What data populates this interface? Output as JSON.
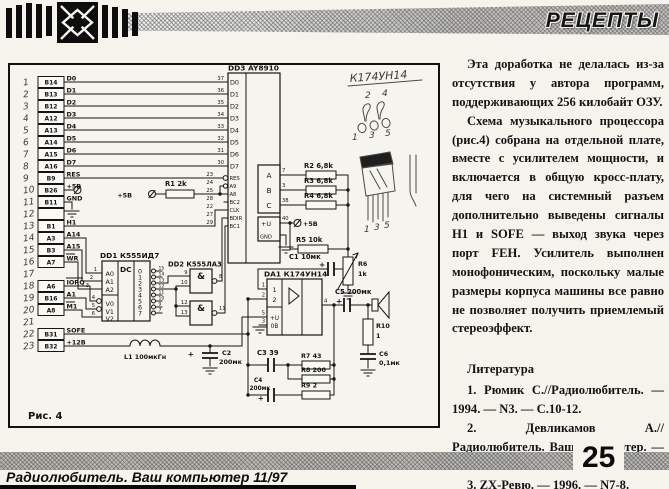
{
  "header": {
    "title": "РЕЦЕПТЫ",
    "logo_icon": "crossed-arrows-emblem"
  },
  "article": {
    "p1": "Эта доработка не делалась из-за отсутствия у автора программ, поддерживающих 256 килобайт ОЗУ.",
    "p2": "Схема музыкального процессора (рис.4) собрана на отдельной плате, вместе с усилителем мощности, и включается в общую кросс-плату, для чего на системный разъем дополнительно выведены сигналы H1 и SOFE — выход звука через порт FEH. Усилитель выполнен монофоническим, поскольку малые размеры корпуса машины все равно не позволяет получить приемлемый стереоэффект.",
    "lit": {
      "heading": "Литература",
      "i1": "1. Рюмик С.//Радиолюбитель. — 1994. — N3. — С.10-12.",
      "i2": "2. Девликамов А.//Радиолюбитель. Ваш компьютер. — 1996. — N7. — С.19-21.",
      "i3": "3. ZX-Ревю. — 1996. — N7-8."
    }
  },
  "footer": {
    "page": "25",
    "line": "Радиолюбитель. Ваш компьютер 11/97"
  },
  "schematic": {
    "caption": "Рис. 4",
    "plus": "+",
    "p5": "+5В",
    "connector": {
      "rows": [
        {
          "hand": "1",
          "pin": "B14",
          "sig": "D0",
          "num": "37"
        },
        {
          "hand": "2",
          "pin": "B13",
          "sig": "D1",
          "num": "36"
        },
        {
          "hand": "3",
          "pin": "B12",
          "sig": "D2",
          "num": "35"
        },
        {
          "hand": "4",
          "pin": "A12",
          "sig": "D3",
          "num": "34"
        },
        {
          "hand": "5",
          "pin": "A13",
          "sig": "D4",
          "num": "33"
        },
        {
          "hand": "6",
          "pin": "A14",
          "sig": "D5",
          "num": "32"
        },
        {
          "hand": "7",
          "pin": "A15",
          "sig": "D6",
          "num": "31"
        },
        {
          "hand": "8",
          "pin": "A16",
          "sig": "D7",
          "num": "30"
        },
        {
          "hand": "9",
          "pin": "B9",
          "sig": "RES",
          "num": ""
        },
        {
          "hand": "10",
          "pin": "B26",
          "sig": "+5В",
          "num": ""
        },
        {
          "hand": "11",
          "pin": "B11",
          "sig": "GND",
          "num": ""
        },
        {
          "hand": "12",
          "pin": "",
          "sig": "",
          "num": "",
          "box": true
        },
        {
          "hand": "13",
          "pin": "B1",
          "sig": "H1",
          "num": ""
        },
        {
          "hand": "14",
          "pin": "A3",
          "sig": "A14",
          "num": ""
        },
        {
          "hand": "15",
          "pin": "B3",
          "sig": "A15",
          "num": ""
        },
        {
          "hand": "16",
          "pin": "A7",
          "sig": "WR",
          "num": "",
          "inv": true
        },
        {
          "hand": "17",
          "pin": "",
          "sig": "",
          "num": ""
        },
        {
          "hand": "18",
          "pin": "A6",
          "sig": "IORQ",
          "num": "",
          "inv": true
        },
        {
          "hand": "19",
          "pin": "B16",
          "sig": "A1",
          "num": ""
        },
        {
          "hand": "20",
          "pin": "A8",
          "sig": "M1",
          "num": "",
          "inv": true
        },
        {
          "hand": "21",
          "pin": "",
          "sig": "",
          "num": ""
        },
        {
          "hand": "22",
          "pin": "B31",
          "sig": "SOFE",
          "num": ""
        },
        {
          "hand": "23",
          "pin": "B32",
          "sig": "+12В",
          "num": ""
        }
      ]
    },
    "dd3": {
      "ref": "DD3 AY8910",
      "dpins": [
        "D0",
        "D1",
        "D2",
        "D3",
        "D4",
        "D5",
        "D6",
        "D7"
      ],
      "ctrl": [
        {
          "num": "23",
          "name": "RES"
        },
        {
          "num": "24",
          "name": "A9"
        },
        {
          "num": "25",
          "name": "A8"
        },
        {
          "num": "28",
          "name": "BC2"
        },
        {
          "num": "22",
          "name": "CLK"
        },
        {
          "num": "27",
          "name": "BDIR"
        },
        {
          "num": "29",
          "name": "BC1"
        }
      ],
      "out": [
        {
          "name": "A",
          "num": "7"
        },
        {
          "name": "B",
          "num": "3"
        },
        {
          "name": "C",
          "num": "38"
        }
      ],
      "pwr": {
        "u": "+U",
        "unum": "40",
        "gnd": "GND"
      }
    },
    "dd1": {
      "ref": "DD1 К555ИД7",
      "dc": "DC",
      "a": [
        "A0",
        "A1",
        "A2"
      ],
      "anums": [
        "1",
        "2",
        "3"
      ],
      "v": [
        "V0",
        "V1",
        "V2"
      ],
      "vnums": [
        "4",
        "5",
        "6"
      ],
      "outs": [
        "0",
        "1",
        "2",
        "3",
        "4",
        "5",
        "6",
        "7"
      ],
      "onums": [
        "15",
        "14",
        "13",
        "12",
        "11",
        "10",
        "9",
        "7"
      ]
    },
    "dd2": {
      "ref": "DD2 К555ЛА3",
      "amp": "&",
      "g1": {
        "a": "9",
        "b": "10",
        "o": "8"
      },
      "g2": {
        "a": "12",
        "b": "13",
        "o": "11"
      }
    },
    "da1": {
      "ref": "DA1 К174УН14",
      "p1": "1",
      "p2": "2",
      "p5": "5",
      "p3": "3",
      "p4": "4",
      "i1": "1",
      "i2": "2",
      "u": "+U",
      "ov": "0В"
    },
    "r": {
      "r1": "R1 2k",
      "r2": "R2 6,8k",
      "r3": "R3 6,8k",
      "r4": "R4 6,8k",
      "r5": "R5 10k",
      "r6a": "R6",
      "r6b": "1k",
      "r7": "R7 43",
      "r8": "R8 200",
      "r9": "R9 2",
      "r10a": "R10",
      "r10b": "1"
    },
    "c": {
      "c1": "C1 10мк",
      "c2a": "C2",
      "c2b": "200мк",
      "c3": "C3 39",
      "c4a": "C4",
      "c4b": "200мк",
      "c5": "C5 200мк",
      "c6a": "C6",
      "c6b": "0,1мк"
    },
    "l1": "L1 100мкГн",
    "hw": {
      "chip": "К174УН14",
      "n2": "2",
      "n4": "4",
      "n1": "1",
      "n3": "3",
      "n5": "5",
      "m1": "1",
      "m3": "3",
      "m5": "5"
    }
  }
}
